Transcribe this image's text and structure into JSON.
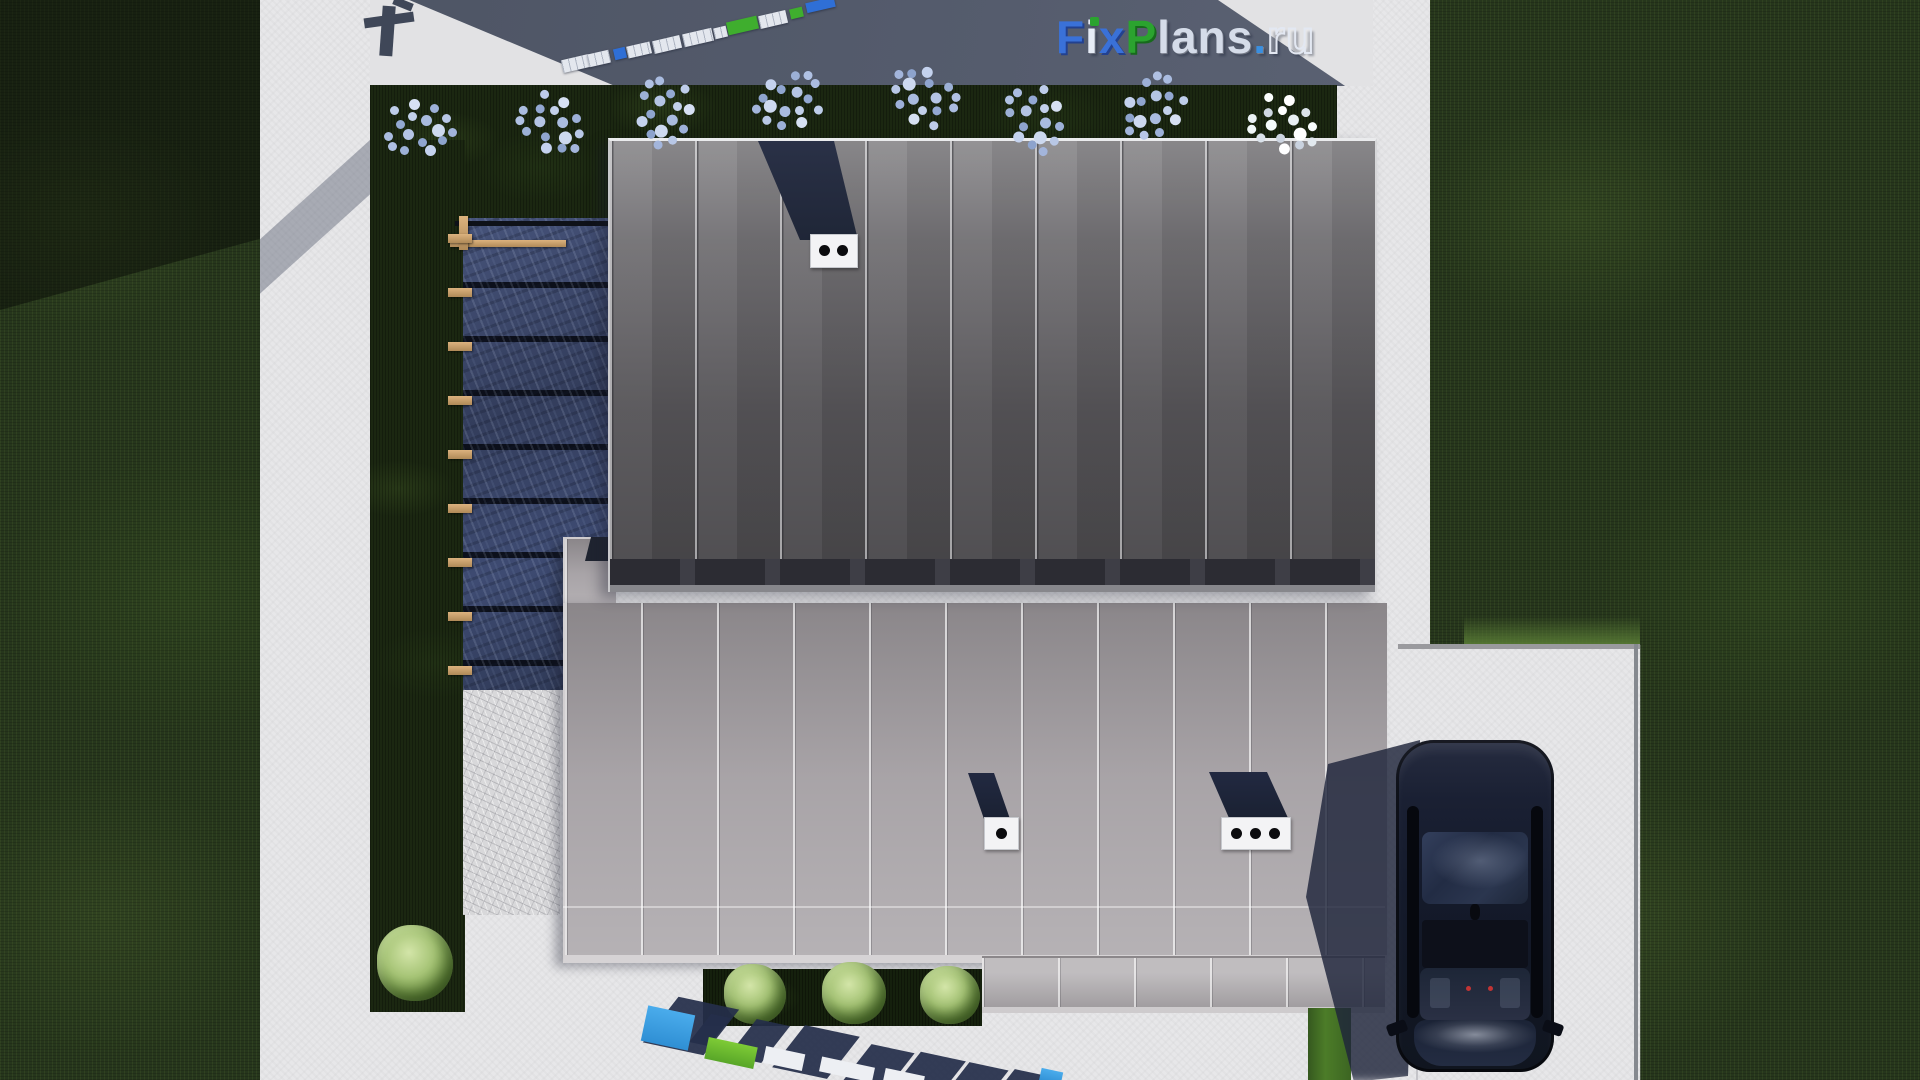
{
  "watermark": {
    "text": "FixPlans.ru",
    "letters": [
      "F",
      "i",
      "x",
      "P",
      "l",
      "a",
      "n",
      "s",
      ".",
      "r",
      "u"
    ],
    "ground_bottom_text": "FixPlans.ru",
    "ground_top_text": "FixPlans.ru"
  },
  "palette": {
    "lawn_green": "#26361c",
    "concrete_white": "#e7e7e9",
    "pavement_shadow": "#535a6b",
    "roof_upper_gray": "#605e62",
    "roof_lower_gray": "#a19ca0",
    "pergola_glass_blue": "#3c4767",
    "wood_tan": "#c9a06a",
    "brand_blue": "#3a71d8",
    "brand_green": "#2ba32f",
    "car_navy": "#141a2b",
    "flower_blue_white": "#c2d0ea",
    "bush_green": "#a6c476"
  }
}
